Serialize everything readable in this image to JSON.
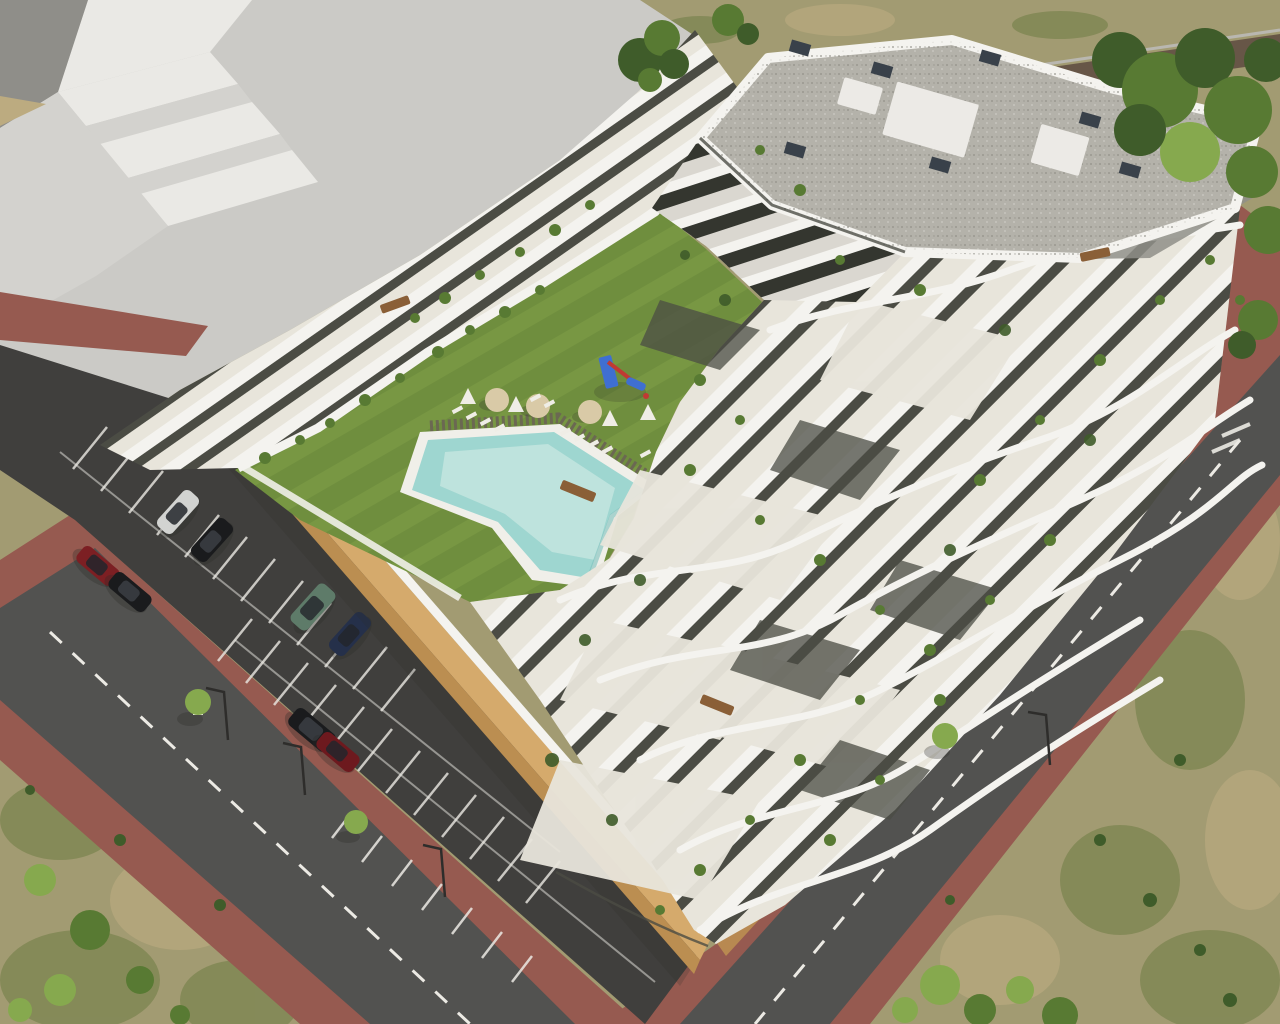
{
  "palette": {
    "plaza": "#cbcac6",
    "massingLight": "#eae9e5",
    "massingMid": "#d3d2ce",
    "massingDark": "#8f8e89",
    "scrubBase": "#a29b72",
    "scrubLight": "#bcab80",
    "scrubGreen": "#77814b",
    "treeDark": "#3f5c2a",
    "treeMid": "#587a33",
    "treeLight": "#86a94e",
    "dirtPath": "#5d4a40",
    "roadAsphalt": "#525250",
    "parkingAsphalt": "#403f3d",
    "roadMark": "#eceae4",
    "sidewalkRed": "#965a50",
    "sidewalkRedShade": "#7c463e",
    "curb": "#b9b7b0",
    "tanWallSun": "#d5aa6c",
    "tanWallShade": "#bb8e51",
    "buildingWhite": "#f4f3ef",
    "bandShadow": "#dad7d0",
    "terraceFloor": "#e8e5db",
    "terraceFloorDark": "#8f8f88",
    "facadeDark": "#4b4c44",
    "facadeGlass": "#34362f",
    "roofGravel": "#b4b2aa",
    "gravelDotDark": "#8f8d85",
    "gravelDotLight": "#d7d5ce",
    "roofBox": "#eceae6",
    "ventDark": "#39414a",
    "lawn": "#6f8e3e",
    "lawnLight": "#83a24a",
    "poolRim": "#f0efe9",
    "poolLight": "#cfeae4",
    "poolMid": "#9ed6d0",
    "poolDeep": "#7cc0bd",
    "deckWood": "#6b6852",
    "parasol": "#d9caa7",
    "loungerWhite": "#efede6",
    "woodFurniture": "#8a5f37",
    "playBlue": "#3f6fd1",
    "playRed": "#c03a33",
    "carSilver": "#d2d3d1",
    "carBlack": "#1a1b1d",
    "carRed": "#7c1f23",
    "carGreen": "#5e7b69",
    "carNavy": "#25304a",
    "carDarkRed": "#6d191e",
    "carGlass": "#23262b",
    "lampPole": "#2e2d2b",
    "shadow": "#2c2c28"
  }
}
